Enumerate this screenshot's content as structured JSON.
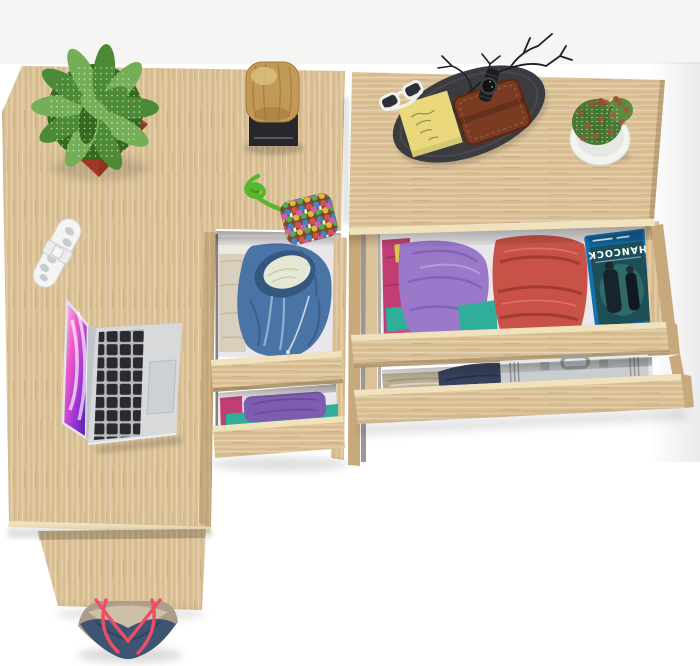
{
  "scene": {
    "description": "Top-down view of a light oak home-office desk with an open laptop and a matching chest of drawers; drawers are open showing folded clothes, a Blu-ray case and an aluminum briefcase; decorative items sit on top and a navy tote bag rests on the floor",
    "furniture": {
      "desk_label": "L-shaped light oak desk",
      "pedestal_label": "Two-drawer desk pedestal, drawers open",
      "dresser_label": "Oak chest of drawers, two drawers open"
    },
    "desk_items": [
      "Speckled succulent in red square planter",
      "Decorative wood log on black stand",
      "White folding multi-tool",
      "Open silver laptop with pink abstract wallpaper",
      "Felt-ball pouch keychain on green cord"
    ],
    "dresser_items": [
      "Black oval valet tray",
      "Yellow sticky note",
      "Brown leather wallet",
      "White-framed sunglasses",
      "Black wristwatch",
      "Black decorative branch",
      "Cactus in round white pot"
    ],
    "pedestal_drawer1_contents": [
      "Blue zip hoodie with cream lining",
      "Folded beige clothes"
    ],
    "pedestal_drawer2_contents": [
      "Folded purple shirt",
      "Folded teal shirt",
      "Magenta garment"
    ],
    "dresser_drawer1_contents": [
      "Stack of pink, yellow and teal shirts",
      "Folded purple shirt",
      "Stack of folded red garments",
      "HANCOCK Blu-ray case"
    ],
    "dresser_drawer2_contents": [
      "Folded khaki trousers",
      "Folded navy garment",
      "Aluminum briefcase"
    ],
    "floor_items": [
      "Navy canvas tote bag with red rope straps"
    ]
  },
  "bluray": {
    "title": "HANCOCK"
  },
  "palette": {
    "wall": "#f5f5f4",
    "floor": "#ffffff",
    "wood_light": "#e7d3ab",
    "wood_mid": "#dcc297",
    "wood_dark": "#c7a97b",
    "wood_edge": "#f0e2bd",
    "interior": "#e9e7ea",
    "pot_red": "#b6432f",
    "pot_red_dark": "#8c2e1c",
    "leaf_green": "#4c8a36",
    "leaf_green_light": "#74af57",
    "leaf_green_dark": "#34691f",
    "log_tan": "#c29a57",
    "log_tan_light": "#e0c385",
    "stand_black": "#28282c",
    "tool_white": "#f4f4f3",
    "laptop_silver": "#d7d9db",
    "laptop_silver_dark": "#c2c5c8",
    "key_black": "#2b2b2f",
    "trackpad_gray": "#ced1d4",
    "screen_light": "#f6d7f3",
    "screen_pink": "#ee58c8",
    "screen_purple": "#8c2fd6",
    "screen_deep": "#4a1d8f",
    "rope_green": "#57b52f",
    "pouch_base": "#7a4a30",
    "hoodie_blue": "#4a74a6",
    "hoodie_blue_dark": "#33577f",
    "hoodie_lining": "#e4e8d5",
    "beige_cloth": "#d8d0bc",
    "purple_cloth": "#9a78ca",
    "purple_cloth_dark": "#7e5cb0",
    "teal_cloth": "#2fae9a",
    "magenta_cloth": "#c23e72",
    "yellow_cloth": "#d9c84e",
    "pink_cloth": "#d0497e",
    "red_stack": "#c85247",
    "red_stack_dark": "#a23b31",
    "red_stack_light": "#dd7066",
    "case_blue": "#1470ae",
    "case_art": "#1d4f59",
    "khaki_cloth": "#b9ae95",
    "khaki_cloth_dark": "#a29878",
    "navy_cloth": "#36415c",
    "gray_cloth": "#93929a",
    "brief_silver": "#c9cdd0",
    "brief_silver_dark": "#9aa0a5",
    "tray_dark": "#3b3b40",
    "note_yellow": "#e9d97c",
    "note_ink": "#8d8147",
    "wallet_brown": "#7b3a22",
    "wallet_brown_dark": "#5c2813",
    "glasses_white": "#f0f0ee",
    "branch_black": "#202024",
    "cactus_green": "#4a7733",
    "cactus_green_light": "#5d8c41",
    "cactus_spine": "#a8503a",
    "cactus_pot": "#f3f3f0",
    "bag_navy": "#3d5573",
    "bag_taupe": "#ab9d8a",
    "bag_interior": "#cdbfa8",
    "strap_red": "#ee4d64"
  }
}
